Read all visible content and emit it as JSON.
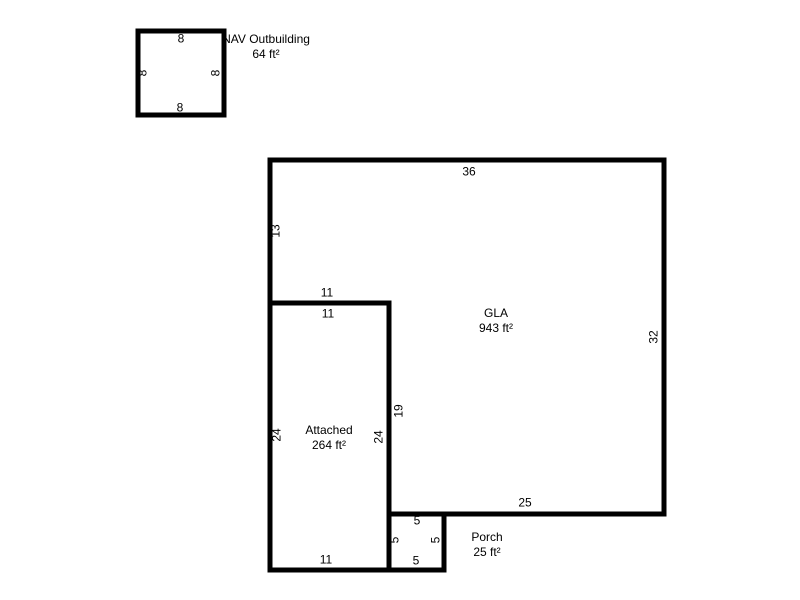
{
  "colors": {
    "line": "#000000",
    "background": "#ffffff",
    "text": "#000000"
  },
  "outbuilding": {
    "label": "NAV Outbuilding",
    "area": "64 ft²",
    "dims": {
      "top": "8",
      "left": "8",
      "right": "8",
      "bottom": "8"
    }
  },
  "gla": {
    "label": "GLA",
    "area": "943 ft²",
    "dims": {
      "top": "36",
      "left": "13",
      "right": "32",
      "notch_top": "11",
      "notch_side": "19",
      "bottom": "25"
    }
  },
  "attached": {
    "label": "Attached",
    "area": "264 ft²",
    "dims": {
      "top": "11",
      "left": "24",
      "right": "24",
      "bottom": "11"
    }
  },
  "porch": {
    "label": "Porch",
    "area": "25 ft²",
    "dims": {
      "top": "5",
      "left": "5",
      "right": "5",
      "bottom": "5"
    }
  }
}
